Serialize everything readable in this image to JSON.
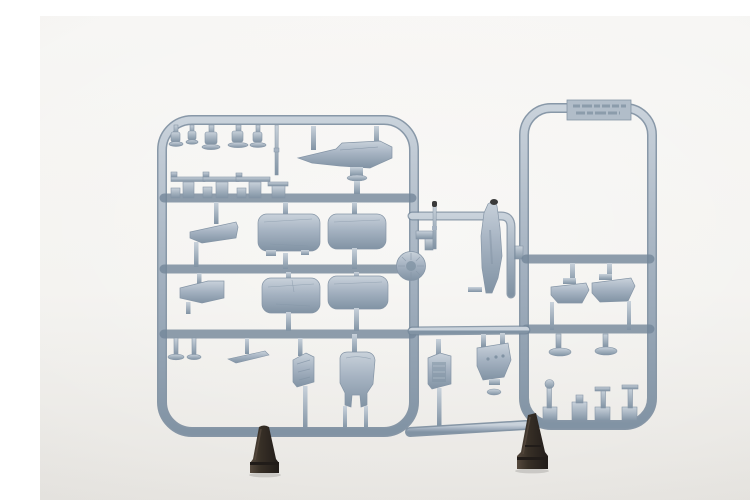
{
  "scene": {
    "description": "Product photograph of a light blue-grey injection-moulded plastic model aircraft sprue (parts frame) standing upright on a seamless white background, supported by two small dark clamp stands at the bottom rail",
    "subject": "plastic model kit sprue with aircraft parts",
    "label_plate": {
      "present": true,
      "text_legible": false
    },
    "frames": {
      "left": "large rectangular parts frame",
      "right": "narrow tall parts frame"
    },
    "supports": {
      "count": 2,
      "type": "dark clamp stands"
    }
  },
  "colors": {
    "background_top": "#f7f6f4",
    "background_bottom": "#e7e5e1",
    "plastic_light": "#c9d2db",
    "plastic_mid": "#a0aebd",
    "plastic_dark": "#8193a4",
    "plastic_edge": "#74879a",
    "part_fill": "#a6b3c2",
    "part_edge": "#8595a6",
    "label_plate": "#b1bdc9",
    "label_emboss": "#8b9cab",
    "clamp_dark": "#211c19",
    "clamp_mid": "#383027",
    "clamp_light": "#55493d",
    "probe_tip": "#3a3a3a"
  }
}
